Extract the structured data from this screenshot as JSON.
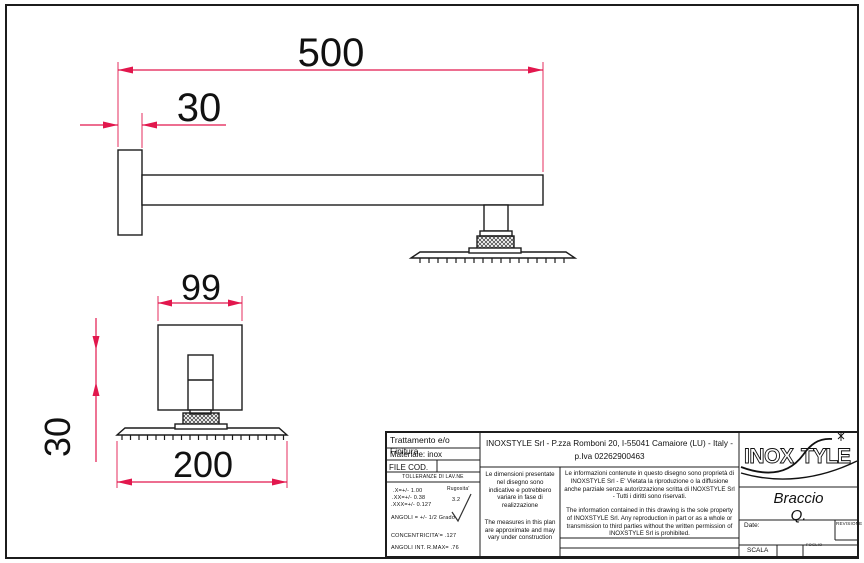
{
  "colors": {
    "dimension": "#e2174d",
    "line": "#1c1c1c"
  },
  "views": {
    "side": {
      "length_dim": "500",
      "plate_depth_dim": "30"
    },
    "front": {
      "plate_width_dim": "99",
      "arm_square_dim": "30",
      "head_width_dim": "200"
    }
  },
  "title_block": {
    "finish_label": "Trattamento e/o Finitura",
    "material": "Materiale: inox",
    "file_cod_label": "FILE COD.",
    "tolerances": {
      "header": "TOLLERANZE DI LAV.NE",
      "lines": [
        ".X=+/- 1.00",
        ".XX=+/- 0.38",
        ".XXX=+/- 0.127"
      ],
      "angles": "ANGOLI = +/- 1/2 Grado",
      "concentricity": "CONCENTRICITA'= .127",
      "internal_angles": "ANGOLI INT. R.MAX= .76",
      "roughness_label": "Rugosita'",
      "roughness_value": "3.2"
    },
    "company_line1": "INOXSTYLE Srl - P.zza Romboni 20, I-55041 Camaiore (LU) - Italy -",
    "company_line2": "p.Iva 02262900463",
    "note_it": "Le dimensioni presentate nel disegno sono indicative e potrebbero variare in fase di realizzazione",
    "note_en": "The measures in this plan are approximate and may vary under construction",
    "legal_it": "Le informazioni contenute in questo disegno sono proprietà di INOXSTYLE Srl - E' Vietata la riproduzione o la diffusione anche parziale senza autorizzazione scritta di INOXSTYLE Srl - Tutti i diritti sono riservati.",
    "legal_en": "The information contained in this drawing is the sole property of INOXSTYLE Srl. Any reproduction in part or as a whole or transmission to third parties without the written permission of INOXSTYLE Srl is prohibited.",
    "logo_part1": "INOX",
    "logo_part2": "TYLE",
    "product_line1": "Braccio",
    "product_line2": "Q.",
    "date_label": "Date:",
    "revision_label": "REVISIONE",
    "scale_label": "SCALA",
    "sheet_label": "FOGLIO"
  }
}
